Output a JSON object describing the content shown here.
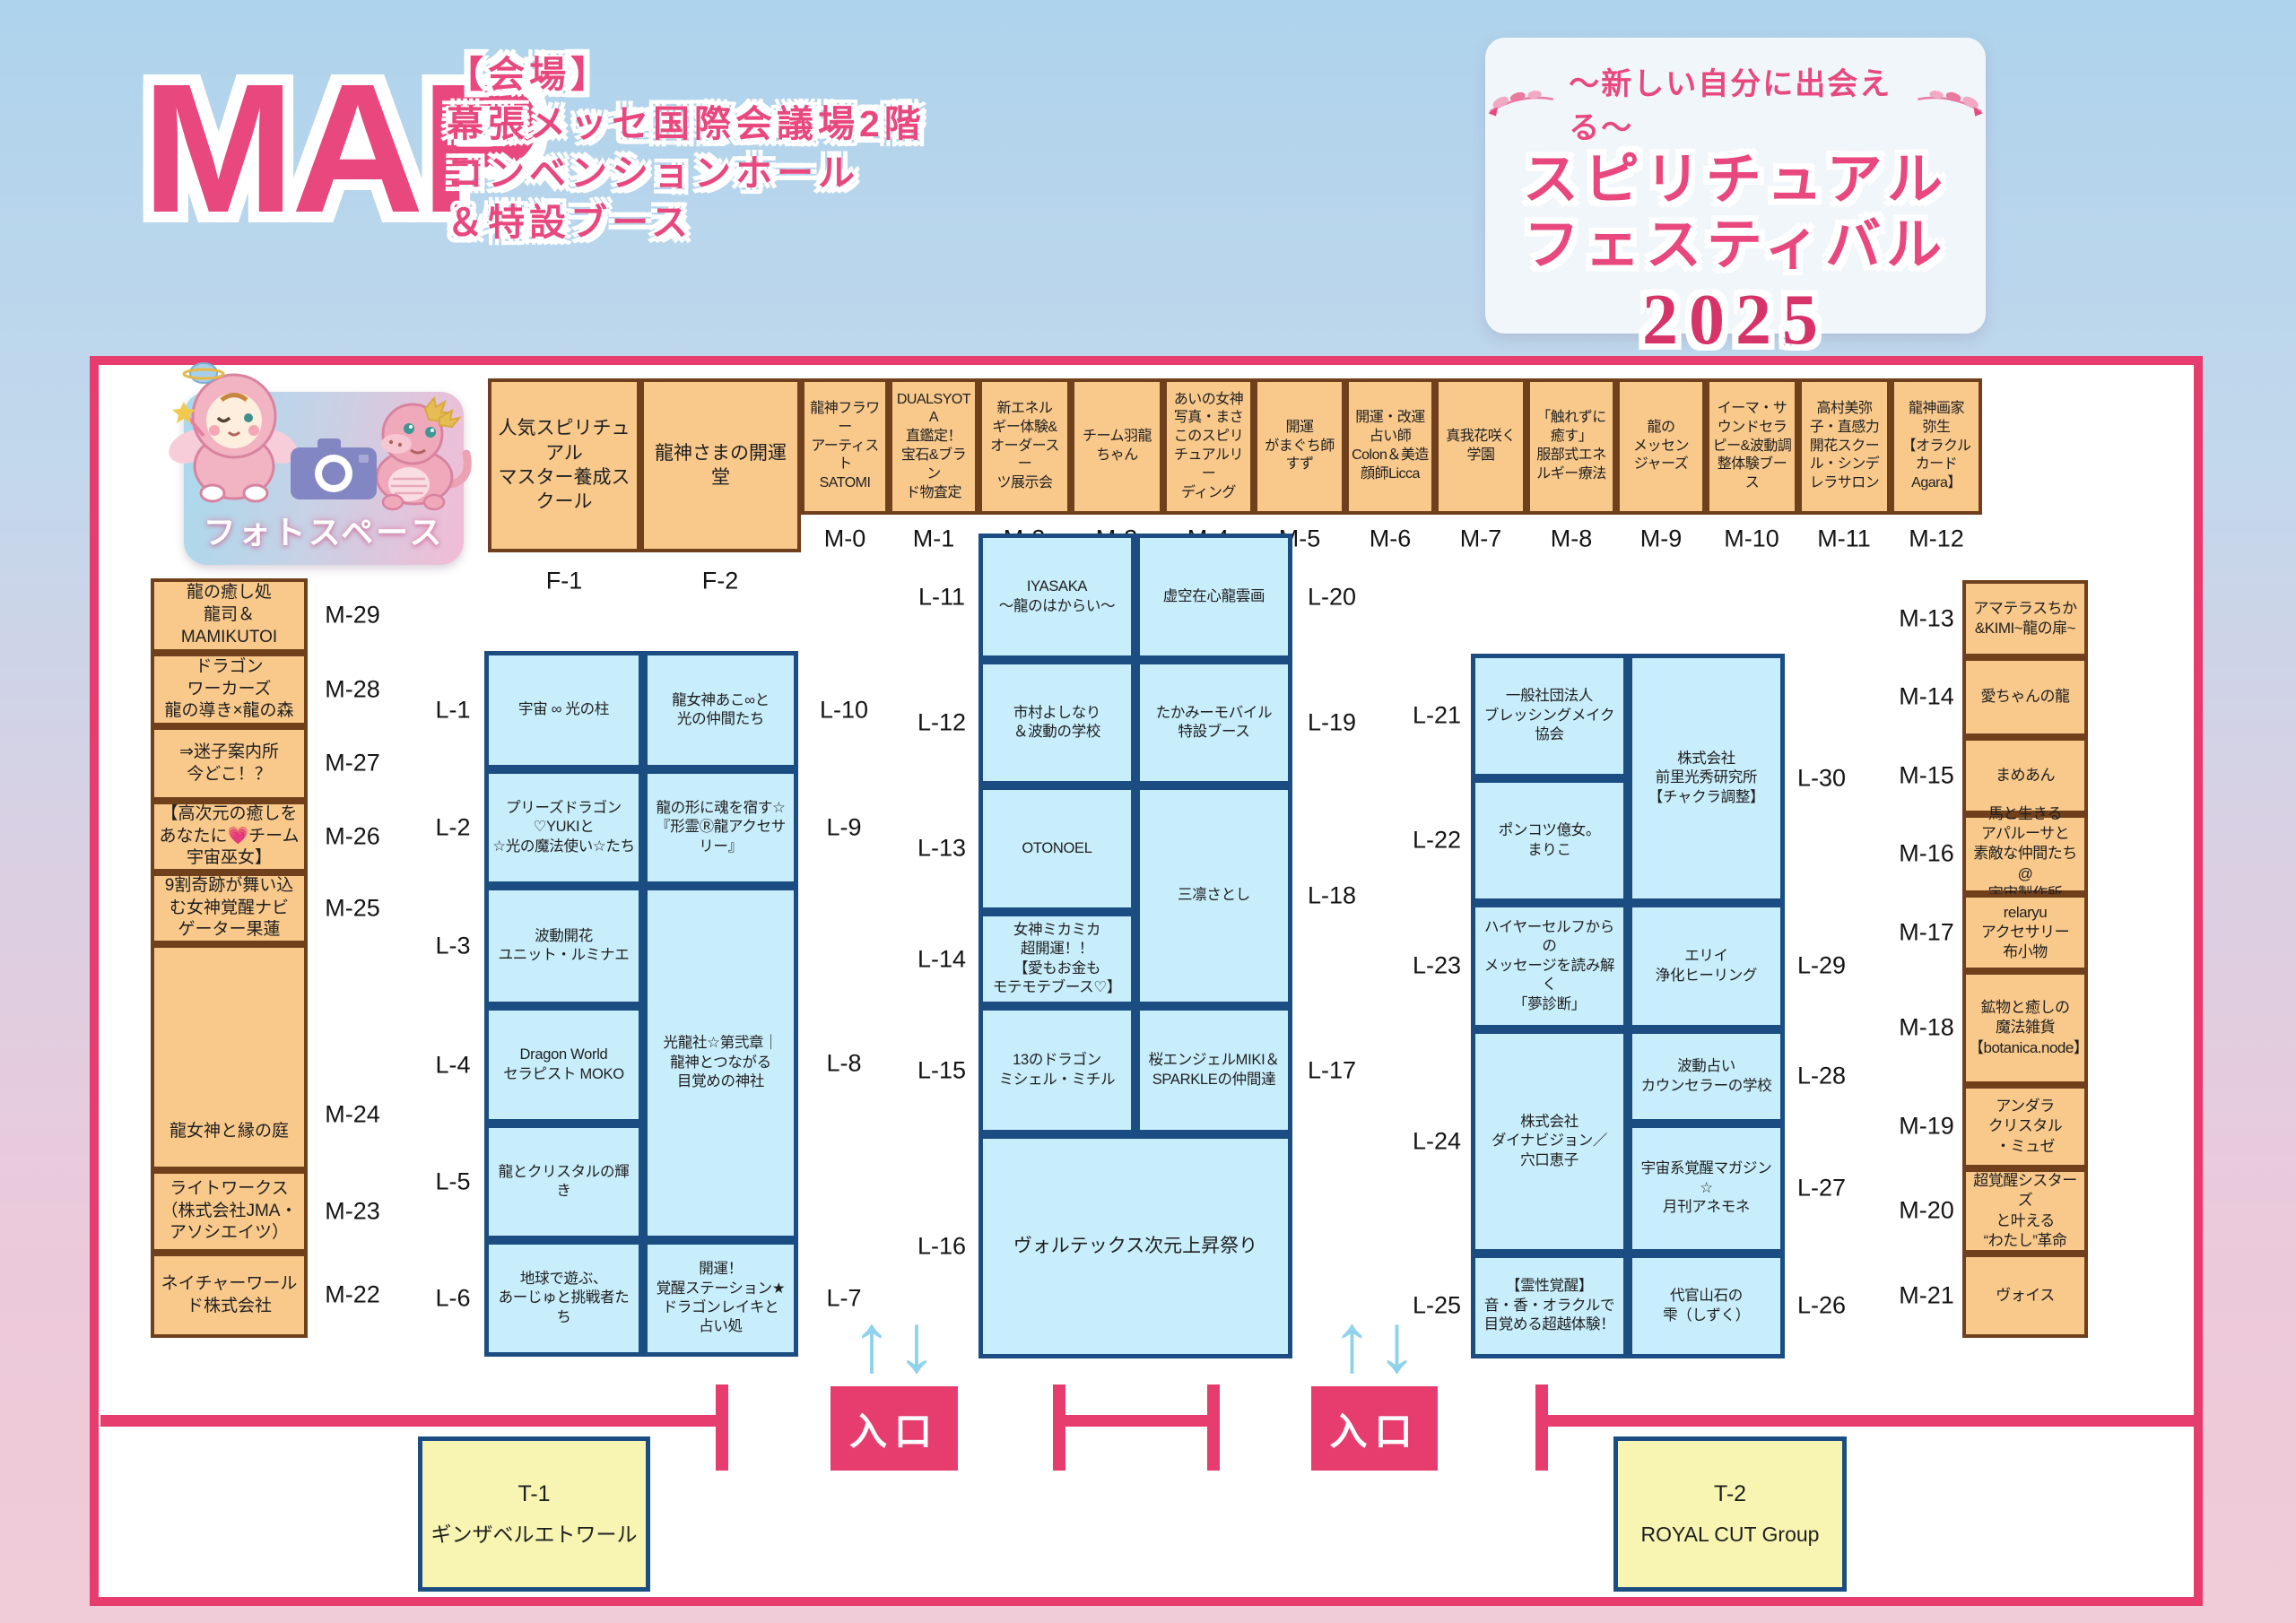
{
  "header": {
    "map_title": "MAP",
    "venue_lines": [
      "【会場】",
      "幕張メッセ国際会議場2階",
      "コンベンションホール",
      "＆特設ブース"
    ],
    "event": {
      "tagline": "～新しい自分に出会える～",
      "title1": "スピリチュアル",
      "title2": "フェスティバル",
      "year": "2025"
    }
  },
  "photo_space": {
    "label": "フォトスペース"
  },
  "entrance": {
    "label": "入口"
  },
  "icons": {
    "up_arrow": "↑",
    "down_arrow": "↓"
  },
  "colors": {
    "accent_pink": "#e8487e",
    "wall_pink": "#e73c6e",
    "booth_orange": "#f9c98c",
    "booth_orange_border": "#70401d",
    "booth_blue": "#c8edfb",
    "booth_blue_border": "#1b4d82",
    "booth_yellow": "#f8f5b2",
    "arrow_blue": "#8fd2ea",
    "year_pink": "#d63369"
  },
  "booths": {
    "f1": {
      "id": "F-1",
      "name": "人気スピリチュアル\nマスター養成スクール"
    },
    "f2": {
      "id": "F-2",
      "name": "龍神さまの開運堂"
    },
    "m0": {
      "id": "M-0",
      "name": "龍神フラワー\nアーティスト\nSATOMI"
    },
    "m1": {
      "id": "M-1",
      "name": "DUALSYOTA\n直鑑定！\n宝石&ブラン\nド物査定"
    },
    "m2": {
      "id": "M-2",
      "name": "新エネル\nギー体験&\nオーダースー\nツ展示会"
    },
    "m3": {
      "id": "M-3",
      "name": "チーム羽龍\nちゃん"
    },
    "m4": {
      "id": "M-4",
      "name": "あいの女神\n写真・まさ\nこのスピリ\nチュアルリー\nディング"
    },
    "m5": {
      "id": "M-5",
      "name": "開運\nがまぐち師\nすず"
    },
    "m6": {
      "id": "M-6",
      "name": "開運・改運\n占い師\nColon＆美造\n顔師Licca"
    },
    "m7": {
      "id": "M-7",
      "name": "真我花咲く\n学園"
    },
    "m8": {
      "id": "M-8",
      "name": "「触れずに\n癒す」\n服部式エネ\nルギー療法"
    },
    "m9": {
      "id": "M-9",
      "name": "龍の\nメッセン\nジャーズ"
    },
    "m10": {
      "id": "M-10",
      "name": "イーマ・サ\nウンドセラ\nピー&波動調\n整体験ブース"
    },
    "m11": {
      "id": "M-11",
      "name": "高村美弥\n子・直感力\n開花スクー\nル・シンデ\nレラサロン"
    },
    "m12": {
      "id": "M-12",
      "name": "龍神画家\n弥生\n【オラクル\nカード\nAgara】"
    },
    "m13": {
      "id": "M-13",
      "name": "アマテラスちか\n&KIMI~龍の扉~"
    },
    "m14": {
      "id": "M-14",
      "name": "愛ちゃんの龍"
    },
    "m15": {
      "id": "M-15",
      "name": "まめあん"
    },
    "m16": {
      "id": "M-16",
      "name": "馬と生きる\nアパルーサと\n素敵な仲間たち@\n宇宙製作所"
    },
    "m17": {
      "id": "M-17",
      "name": "relaryu\nアクセサリー\n布小物"
    },
    "m18": {
      "id": "M-18",
      "name": "鉱物と癒しの\n魔法雑貨\n【botanica.node】"
    },
    "m19": {
      "id": "M-19",
      "name": "アンダラ\nクリスタル\n・ミュゼ"
    },
    "m20": {
      "id": "M-20",
      "name": "超覚醒シスターズ\nと叶える\n“わたし”革命"
    },
    "m21": {
      "id": "M-21",
      "name": "ヴォイス"
    },
    "m22": {
      "id": "M-22",
      "name": "ネイチャーワール\nド株式会社"
    },
    "m23": {
      "id": "M-23",
      "name": "ライトワークス\n（株式会社JMA・\nアソシエイツ）"
    },
    "m24": {
      "id": "M-24",
      "name": "龍女神と縁の庭"
    },
    "m25": {
      "id": "M-25",
      "name": "9割奇跡が舞い込\nむ女神覚醒ナビ\nゲーター果蓮"
    },
    "m26": {
      "id": "M-26",
      "name": "【高次元の癒しを\nあなたに💗チーム\n宇宙巫女】"
    },
    "m27": {
      "id": "M-27",
      "name": "⇒迷子案内所\n今どこ！？"
    },
    "m28": {
      "id": "M-28",
      "name": "ドラゴン\nワーカーズ\n龍の導き×龍の森"
    },
    "m29": {
      "id": "M-29",
      "name": "龍の癒し処\n龍司＆\nMAMIKUTOI"
    },
    "l1": {
      "id": "L-1",
      "name": "宇宙 ∞ 光の柱"
    },
    "l2": {
      "id": "L-2",
      "name": "プリーズドラゴン\n♡YUKIと\n☆光の魔法使い☆たち"
    },
    "l3": {
      "id": "L-3",
      "name": "波動開花\nユニット・ルミナエ"
    },
    "l4": {
      "id": "L-4",
      "name": "Dragon World\nセラピスト MOKO"
    },
    "l5": {
      "id": "L-5",
      "name": "龍とクリスタルの輝き"
    },
    "l6": {
      "id": "L-6",
      "name": "地球で遊ぶ、\nあーじゅと挑戦者たち"
    },
    "l7": {
      "id": "L-7",
      "name": "開運！\n覚醒ステーション★\nドラゴンレイキと\n占い処"
    },
    "l8": {
      "id": "L-8",
      "name": "光龍社☆第弐章｜\n龍神とつながる\n目覚めの神社"
    },
    "l9": {
      "id": "L-9",
      "name": "龍の形に魂を宿す☆\n『形霊Ⓡ龍アクセサ\nリー』"
    },
    "l10": {
      "id": "L-10",
      "name": "龍女神あこ∞と\n光の仲間たち"
    },
    "l11": {
      "id": "L-11",
      "name": "IYASAKA\n～龍のはからい～"
    },
    "l12": {
      "id": "L-12",
      "name": "市村よしなり\n＆波動の学校"
    },
    "l13": {
      "id": "L-13",
      "name": "OTONOEL"
    },
    "l14": {
      "id": "L-14",
      "name": "女神ミカミカ\n超開運！！\n【愛もお金も\nモテモテブース♡】"
    },
    "l15": {
      "id": "L-15",
      "name": "13のドラゴン\nミシェル・ミチル"
    },
    "l16": {
      "id": "L-16",
      "name": "ヴォルテックス次元上昇祭り"
    },
    "l17": {
      "id": "L-17",
      "name": "桜エンジェルMIKI＆\nSPARKLEの仲間達"
    },
    "l18": {
      "id": "L-18",
      "name": "三凛さとし"
    },
    "l19": {
      "id": "L-19",
      "name": "たかみーモバイル\n特設ブース"
    },
    "l20": {
      "id": "L-20",
      "name": "虚空在心龍雲画"
    },
    "l21": {
      "id": "L-21",
      "name": "一般社団法人\nブレッシングメイク\n協会"
    },
    "l22": {
      "id": "L-22",
      "name": "ポンコツ億女。\nまりこ"
    },
    "l23": {
      "id": "L-23",
      "name": "ハイヤーセルフからの\nメッセージを読み解く\n「夢診断」"
    },
    "l24": {
      "id": "L-24",
      "name": "株式会社\nダイナビジョン／\n穴口恵子"
    },
    "l25": {
      "id": "L-25",
      "name": "【霊性覚醒】\n音・香・オラクルで\n目覚める超越体験！"
    },
    "l26": {
      "id": "L-26",
      "name": "代官山石の\n雫（しずく）"
    },
    "l27": {
      "id": "L-27",
      "name": "宇宙系覚醒マガジン☆\n月刊アネモネ"
    },
    "l28": {
      "id": "L-28",
      "name": "波動占い\nカウンセラーの学校"
    },
    "l29": {
      "id": "L-29",
      "name": "エリイ\n浄化ヒーリング"
    },
    "l30": {
      "id": "L-30",
      "name": "株式会社\n前里光秀研究所\n【チャクラ調整】"
    },
    "t1": {
      "id": "T-1",
      "name": "ギンザベルエトワール"
    },
    "t2": {
      "id": "T-2",
      "name": "ROYAL CUT Group"
    }
  }
}
